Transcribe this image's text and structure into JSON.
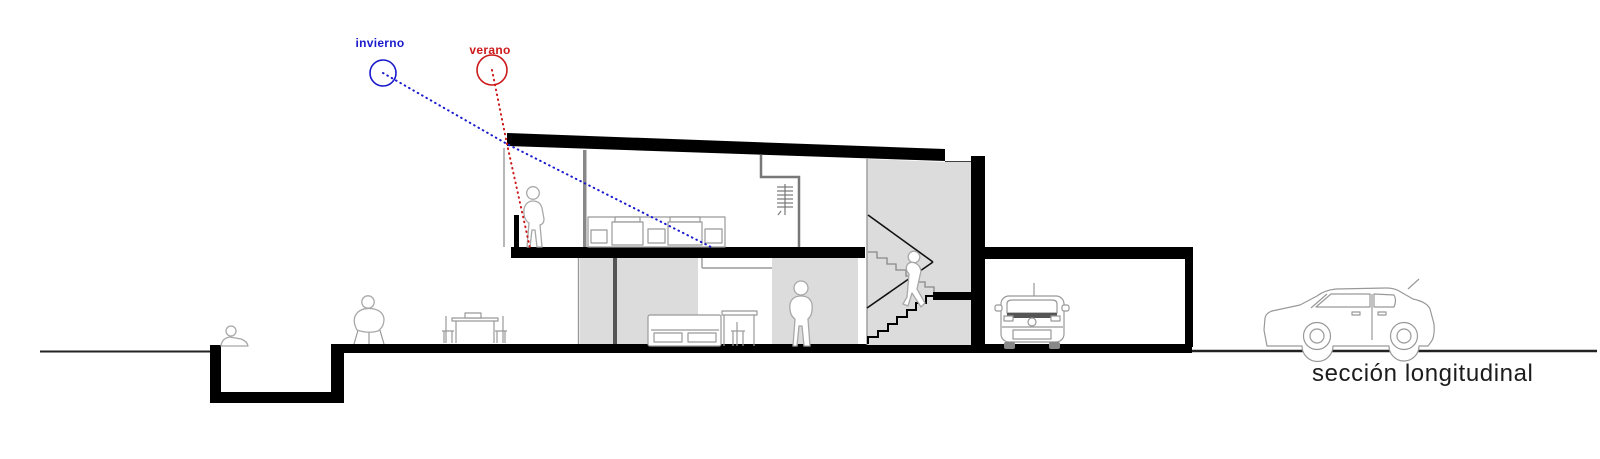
{
  "drawing": {
    "caption": "sección longitudinal",
    "sun_annotations": {
      "winter": "invierno",
      "summer": "verano"
    },
    "colors": {
      "winter-color": "#1a1acd",
      "summer-color": "#cc1a1a",
      "wall-fill": "#dcdcdc",
      "ink": "#000000",
      "outline": "#999999",
      "caption-ink": "#1c1c1c"
    },
    "scene": [
      "two-storey house cut in longitudinal section with mono-pitched roof",
      "winter and summer sun rays entering through the high window at the roof edge",
      "upper floor: standing figure, kitchen counter, closet with ladder",
      "ground floor: sofa, side table, standing figure",
      "switchback staircase with figure walking down",
      "garage with parked car seen from rear",
      "sunken pool with seated figure at left",
      "figure on stool and outdoor dining table with two chairs",
      "hatchback car on the street at right"
    ]
  }
}
